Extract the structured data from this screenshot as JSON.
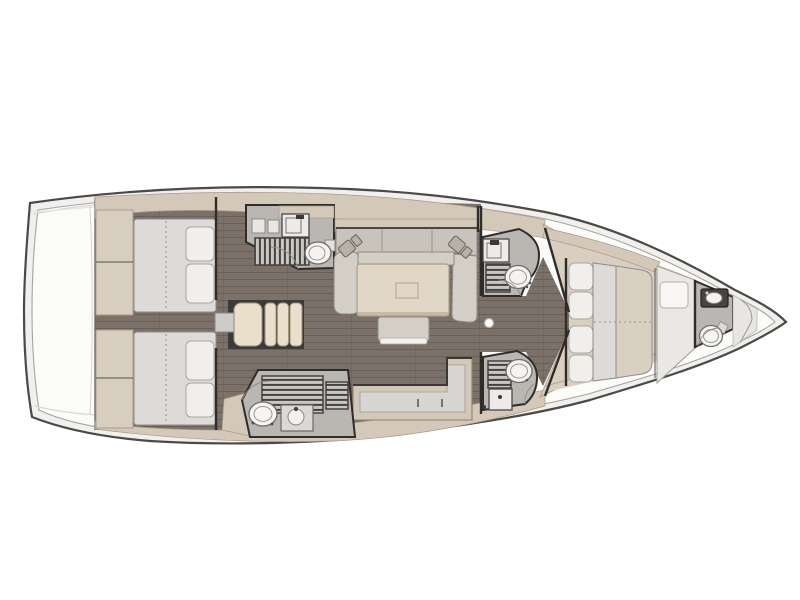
{
  "meta": {
    "description": "Overhead interior deck plan of a sailing yacht: two aft double cabins, aft head with shower, salon with U-shaped settee and table, L-shaped galley counter, two midship heads, forward owner cabin with island berth, and a bow head.",
    "view": "top-down floor plan",
    "bow_direction": "right",
    "stern_direction": "left"
  },
  "palette": {
    "page_bg": "#ffffff",
    "hull_line": "#4b4a47",
    "rim_fill": "#f1f0ee",
    "deck_fill": "#fbfbfa",
    "deck_line": "#a6a4a1",
    "band": "#d4c9b9",
    "band_line": "#a89b85",
    "floor": "#7b7168",
    "floor_line": "#695f58",
    "fwd_floor": "#d9cfc1",
    "bath_floor": "#bab7b3",
    "wall": "#2e2d2a",
    "fixture": "#f5f4f2",
    "fixture_line": "#6f6d68",
    "grate_frame": "#454340",
    "grate_slat": "#cac7c2",
    "mattress": "#dcdbd8",
    "mattress_beige": "#d8d1c2",
    "pillow": "#f0efec",
    "pillow_line": "#a9a5a0",
    "wardrobe": "#d8cec0",
    "sofa": "#c8c3bb",
    "sofa_light": "#d3cec6",
    "sofa_line": "#8e8a83",
    "table": "#e1d7c5",
    "table_line": "#aa9c83",
    "counter": "#d7d5d2",
    "step": "#e9dfcb",
    "step_line": "#a29681",
    "white_unit": "#e9e8e5"
  },
  "components": {
    "hull": "yacht hull outline with toe-rail rim",
    "transom": "stern swim platform",
    "aft_cabin_upper": "aft double-berth cabin with wardrobe",
    "aft_cabin_lower": "aft double-berth cabin with wardrobe",
    "companionway_steps": "companionway stairs between aft cabins",
    "aft_head": "aft bathroom: cabinet, sink, shower grate, toilet",
    "sideboard": "sideboard shelf behind settee",
    "salon_sofa": "U-shaped salon settee with two reading lamps",
    "salon_table": "salon dining table",
    "ottoman": "movable bench seat at table",
    "galley": "L-shaped galley counter with cabinet fronts",
    "mid_head_upper": "midship bathroom: sink, shower grate, toilet",
    "mid_head_lower": "midship bathroom: shower grate, toilet, sink",
    "mast_post": "mast compression post in passageway",
    "forward_cabin": "forward owner cabin with island double berth and pillows",
    "forward_wet_unit": "forward shower/wardrobe unit",
    "forward_head": "bow bathroom with vanity sink and toilet",
    "bow_locker": "bow anchor locker"
  }
}
